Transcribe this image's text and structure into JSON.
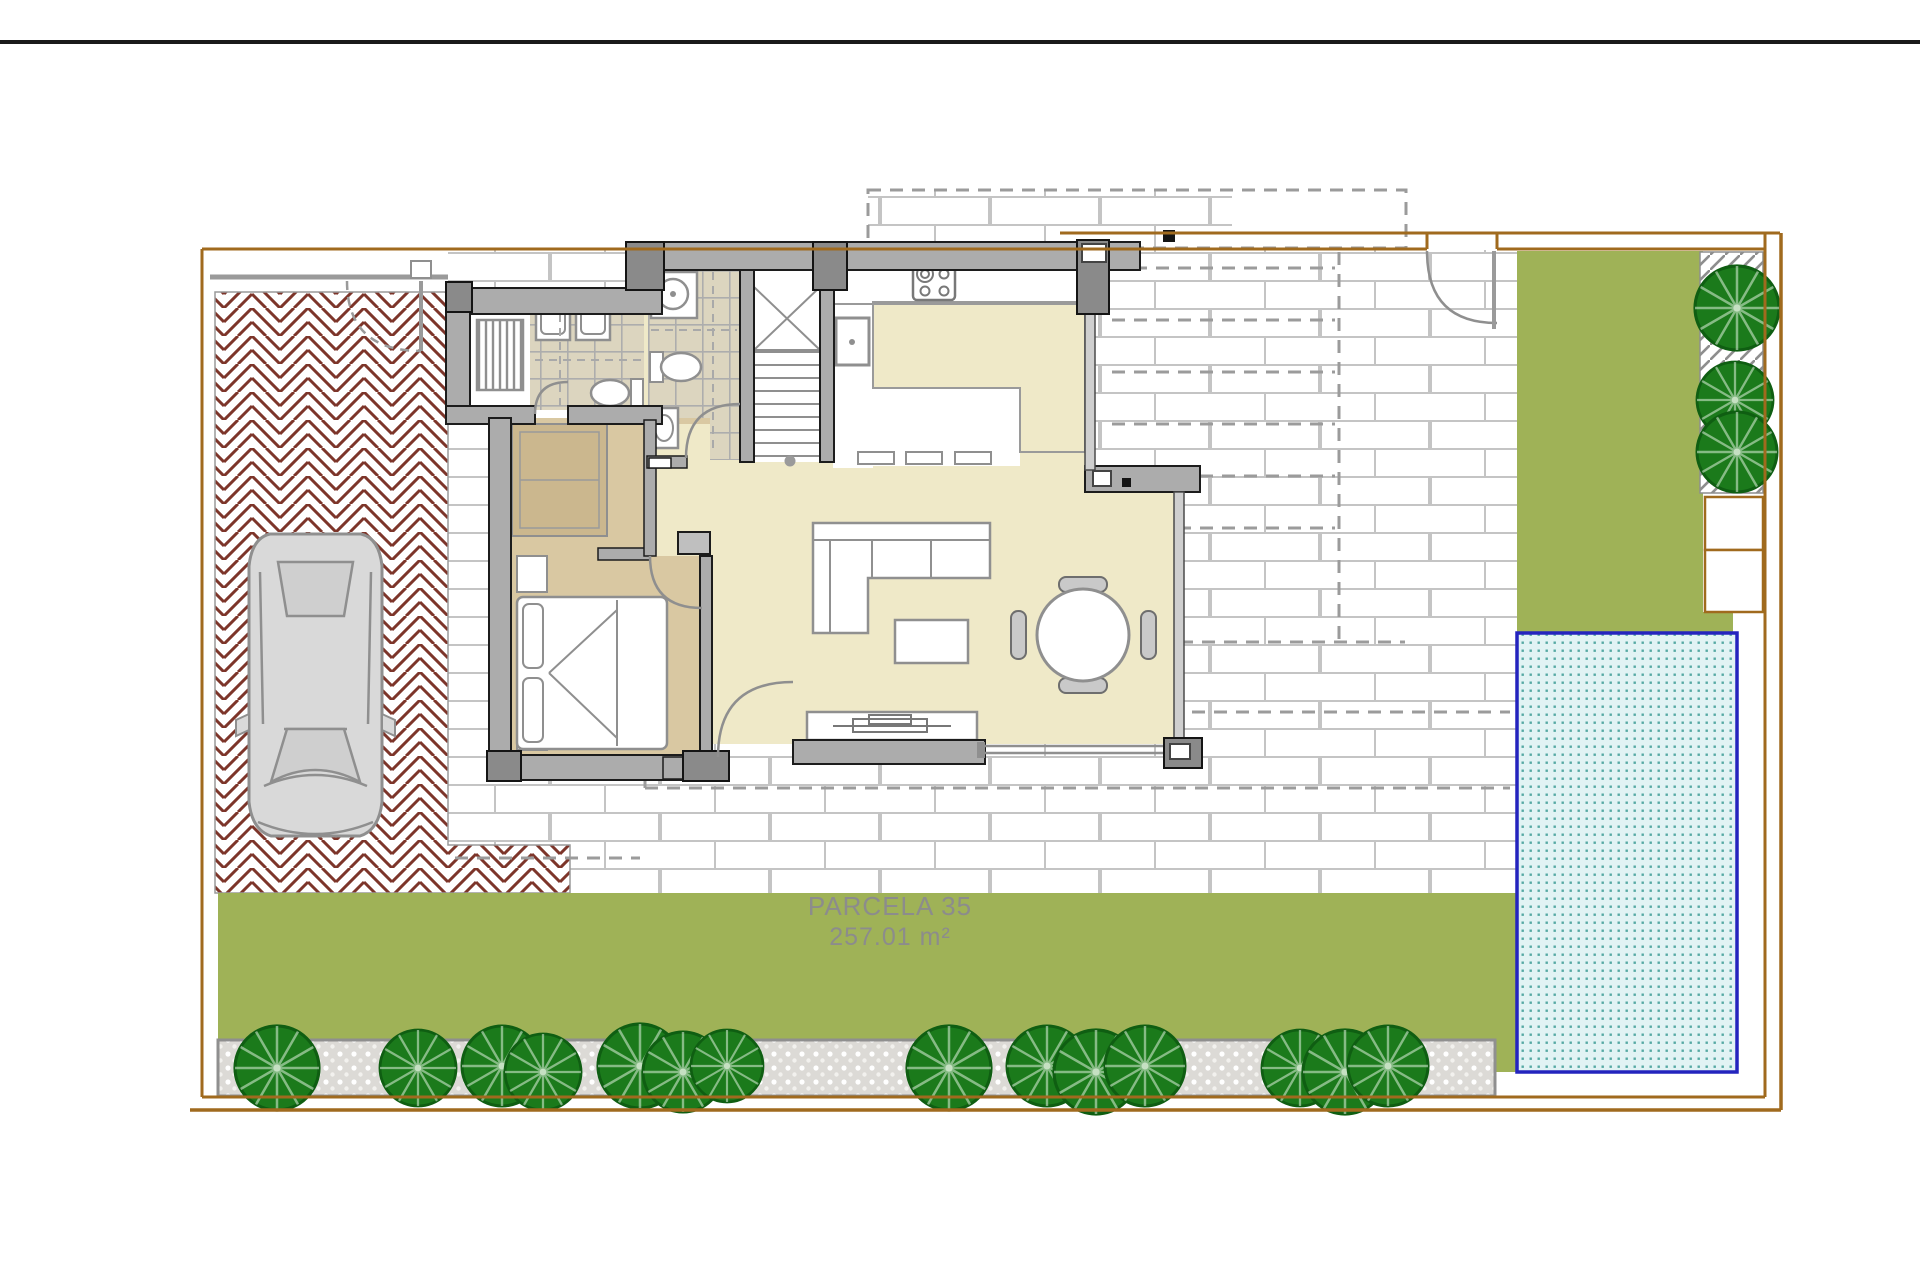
{
  "document": {
    "type": "architectural-site-plan"
  },
  "parcel": {
    "name": "PARCELA 35",
    "area": "257.01 m²"
  },
  "colors": {
    "top_rule": "#1A1A1A",
    "boundary": "#A06A1E",
    "grass": "#9FB257",
    "tree_fill": "#1B7A1B",
    "herringbone": "#7D352A",
    "pool_border": "#2424BE",
    "pool_water": "#E1F3F4",
    "pool_dots": "#55A9A3",
    "wall_fill": "#ACACAC",
    "wall_outline": "#1C1C1C",
    "floor_living": "#EFE9C8",
    "floor_bedroom": "#D9C8A2",
    "bath_tile": "#DCD5BF",
    "terrace_joint": "#C4C4C4",
    "gravel_bg": "#DCDAD6",
    "car_body": "#D9D9D9",
    "label_text": "#8C8C8C"
  },
  "landscape": {
    "bottom_trees": [
      {
        "x": 277,
        "y": 1068,
        "r": 42
      },
      {
        "x": 418,
        "y": 1068,
        "r": 38
      },
      {
        "x": 502,
        "y": 1066,
        "r": 40
      },
      {
        "x": 543,
        "y": 1072,
        "r": 38
      },
      {
        "x": 640,
        "y": 1066,
        "r": 42
      },
      {
        "x": 683,
        "y": 1072,
        "r": 40
      },
      {
        "x": 727,
        "y": 1066,
        "r": 36
      },
      {
        "x": 949,
        "y": 1068,
        "r": 42
      },
      {
        "x": 1047,
        "y": 1066,
        "r": 40
      },
      {
        "x": 1096,
        "y": 1072,
        "r": 42
      },
      {
        "x": 1145,
        "y": 1066,
        "r": 40
      },
      {
        "x": 1300,
        "y": 1068,
        "r": 38
      },
      {
        "x": 1345,
        "y": 1072,
        "r": 42
      },
      {
        "x": 1388,
        "y": 1066,
        "r": 40
      }
    ],
    "side_trees": [
      {
        "x": 1737,
        "y": 308,
        "r": 42
      },
      {
        "x": 1735,
        "y": 400,
        "r": 38
      },
      {
        "x": 1737,
        "y": 452,
        "r": 40
      }
    ]
  }
}
